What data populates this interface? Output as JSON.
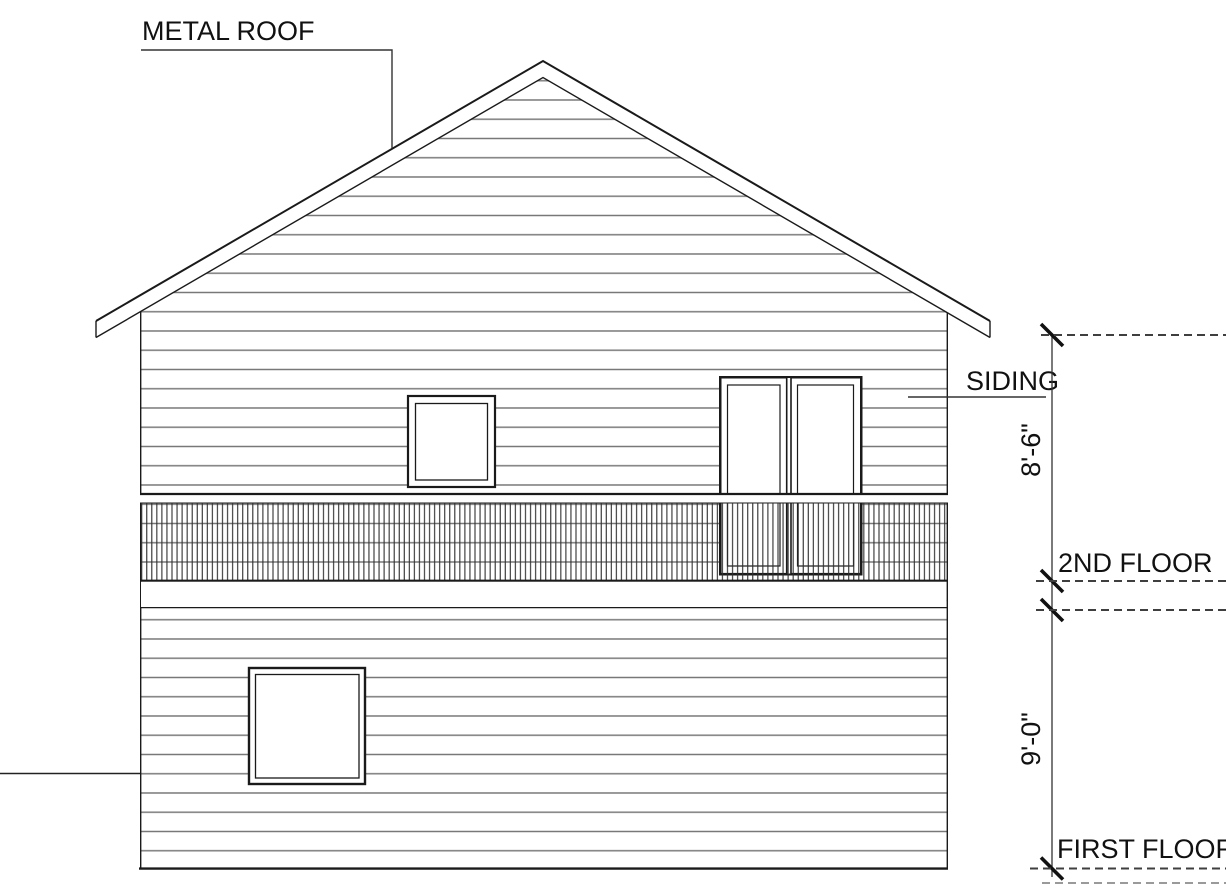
{
  "labels": {
    "metal_roof": "METAL ROOF",
    "siding": "SIDING",
    "second_floor": "2ND FLOOR",
    "first_floor": "FIRST FLOOR"
  },
  "dimensions": {
    "upper_wall_height": "8'-6\"",
    "lower_wall_height": "9'-0\""
  },
  "colors": {
    "bg": "#ffffff",
    "outline": "#1a1a1a",
    "siding": "#777777",
    "dash": "#3f3f3f",
    "dash-light": "#9a9a9a",
    "text": "#111111"
  }
}
